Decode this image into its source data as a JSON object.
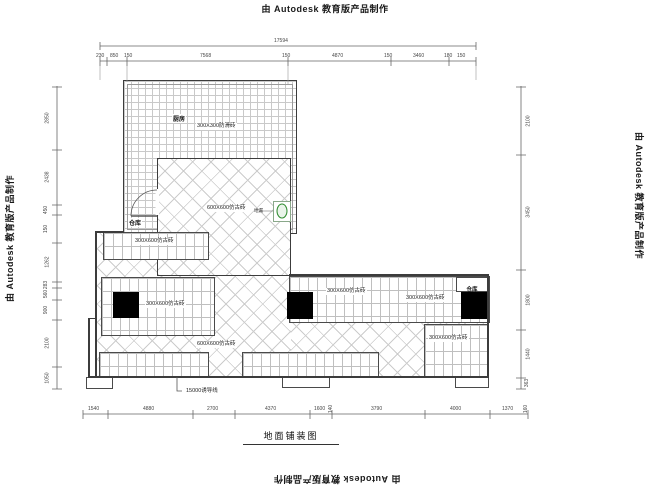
{
  "edge_labels": {
    "top": "由 Autodesk 教育版产品制作",
    "bottom": "由 Autodesk 教育版产品制作",
    "left": "由 Autodesk 教育版产品制作",
    "right": "由 Autodesk 教育版产品制作"
  },
  "title": "地面铺装图",
  "plan": {
    "kitchen_label": "厨房",
    "kitchen_tile": "300X300防滑砖",
    "storage_left": "仓库",
    "storage_right": "仓库",
    "diag_upper": "600X600仿古砖",
    "diag_lower": "600X600仿古砖",
    "band1": "300X600仿古砖",
    "band2": "300X600仿古砖",
    "band3a": "300X600仿古砖",
    "band3b": "300X600仿古砖",
    "band4": "300X600仿古砖",
    "leader": "15000诱导线",
    "drain": "地漏"
  },
  "colors": {
    "wall": "#3c3c3c",
    "tile_line": "#c9c9c9",
    "dimension": "#555555",
    "drain_green": "#2e8b2e",
    "column_fill": "#000000"
  },
  "dimensions": {
    "top_total": "17594",
    "top": [
      "230",
      "850",
      "150",
      "7568",
      "150",
      "4870",
      "150",
      "3460",
      "180",
      "150"
    ],
    "bottom": [
      "1540",
      "4880",
      "2700",
      "4370",
      "1600",
      "140",
      "3790",
      "4000",
      "1370",
      "160"
    ],
    "left": [
      "2850",
      "2438",
      "450",
      "150",
      "1262",
      "283",
      "560",
      "900",
      "2100",
      "1050"
    ],
    "right": [
      "2100",
      "3450",
      "1800",
      "1440",
      "363"
    ]
  }
}
